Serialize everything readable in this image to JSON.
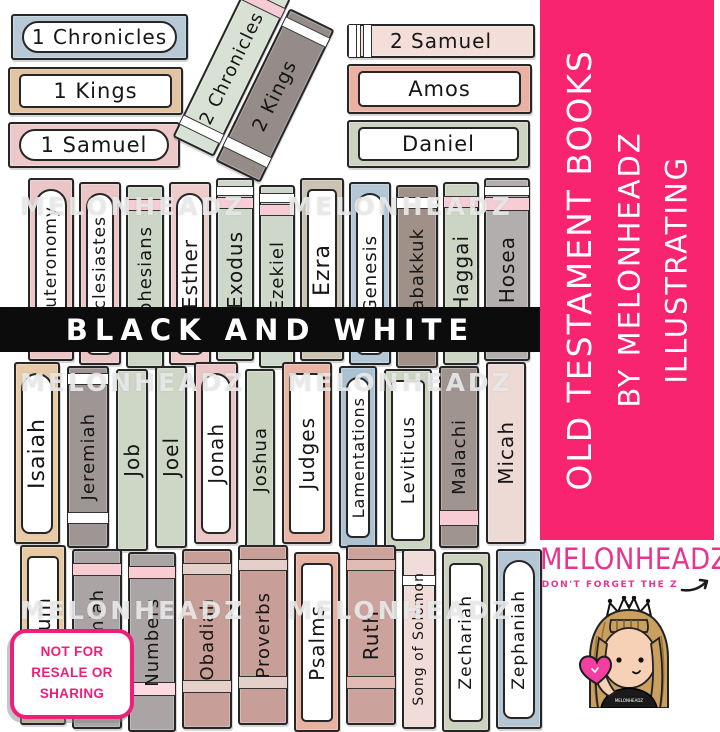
{
  "banner": {
    "text": "BLACK AND WHITE",
    "bg": "#0c0c0c",
    "text_color": "#ffffff"
  },
  "watermark": {
    "text": "MELONHEADZ"
  },
  "sidebar": {
    "bg": "#f9246f",
    "lines": [
      "OLD TESTAMENT BOOKS",
      "BY MELONHEADZ",
      "ILLUSTRATING"
    ]
  },
  "logo": {
    "name": "MELONHEADZ",
    "tagline": "DON'T FORGET THE Z",
    "color": "#e9338f"
  },
  "character": {
    "shirt_text": "MELONHEADZ"
  },
  "badge": {
    "color": "#ee1f78",
    "lines": [
      "NOT FOR",
      "RESALE OR",
      "SHARING"
    ]
  },
  "top_left_books": [
    {
      "label": "1 Chronicles",
      "color": "#b7c9d6",
      "label_type": "pill",
      "w": 177,
      "h": 46,
      "font": 20
    },
    {
      "label": "1 Kings",
      "color": "#e2c4a2",
      "label_type": "rect",
      "w": 175,
      "h": 48,
      "font": 21
    },
    {
      "label": "1 Samuel",
      "color": "#ecc8c8",
      "label_type": "pill",
      "w": 172,
      "h": 46,
      "font": 21
    }
  ],
  "diagonal_books": [
    {
      "label": "2 Chronicles",
      "color": "#d8e2d4",
      "w": 46,
      "h": 176,
      "font": 18,
      "bands": [
        {
          "color": "#f6ccd4",
          "top": 9,
          "h": 10
        },
        {
          "color": "#ffffff",
          "bottom": 12,
          "h": 9
        }
      ]
    },
    {
      "label": "2 Kings",
      "color": "#958c89",
      "w": 50,
      "h": 170,
      "font": 19,
      "bands": [
        {
          "color": "#ffffff",
          "top": 7,
          "h": 9
        },
        {
          "color": "#ffffff",
          "bottom": 14,
          "h": 10
        }
      ]
    }
  ],
  "top_right_books": [
    {
      "label": "2 Samuel",
      "color": "#f3ded9",
      "w": 188,
      "h": 34,
      "font": 20,
      "bands": [
        {
          "color": "#ffffff",
          "left": 4,
          "w": 6
        },
        {
          "color": "#ffffff",
          "left": 14,
          "w": 7
        },
        {
          "color": "#ffffff",
          "right": 4,
          "w": 6
        },
        {
          "color": "#ffffff",
          "right": 14,
          "w": 7
        }
      ]
    },
    {
      "label": "Amos",
      "color": "#e9b2a2",
      "label_type": "rect",
      "w": 185,
      "h": 50,
      "font": 21
    },
    {
      "label": "Daniel",
      "color": "#cdd3c1",
      "label_type": "rect",
      "w": 183,
      "h": 48,
      "font": 21
    }
  ],
  "shelves": [
    {
      "books": [
        {
          "label": "Deuteronomy",
          "color": "#eac6c6",
          "label_type": "arch",
          "w": 46,
          "font": 17
        },
        {
          "label": "Ecclesiastes",
          "color": "#eac6c6",
          "label_type": "arch",
          "w": 42,
          "font": 17
        },
        {
          "label": "Ephesians",
          "color": "#ccd6c6",
          "w": 38,
          "font": 18,
          "bands": [
            {
              "color": "#f7ccd4",
              "top": 12,
              "h": 10
            }
          ]
        },
        {
          "label": "Esther",
          "color": "#eecccc",
          "label_type": "arch",
          "w": 42,
          "font": 20
        },
        {
          "label": "Exodus",
          "color": "#cdd8ca",
          "w": 38,
          "font": 20,
          "bands": [
            {
              "color": "#ffffff",
              "top": 6,
              "h": 8
            },
            {
              "color": "#f7ccd4",
              "top": 17,
              "h": 10
            }
          ]
        },
        {
          "label": "Ezekiel",
          "color": "#cdd8ca",
          "w": 36,
          "font": 18,
          "bands": [
            {
              "color": "#ffffff",
              "top": 6,
              "h": 8
            },
            {
              "color": "#f7ccd4",
              "top": 17,
              "h": 10
            }
          ]
        },
        {
          "label": "Ezra",
          "color": "#cbc4b2",
          "label_type": "rect",
          "w": 44,
          "font": 22
        },
        {
          "label": "Genesis",
          "color": "#b3c7d6",
          "label_type": "arch",
          "w": 42,
          "font": 18
        },
        {
          "label": "Habakkuk",
          "color": "#a09188",
          "w": 42,
          "font": 18,
          "bands": [
            {
              "color": "#ffffff",
              "top": 10,
              "h": 10
            }
          ]
        },
        {
          "label": "Haggai",
          "color": "#ccd4c4",
          "w": 36,
          "font": 20,
          "bands": [
            {
              "color": "#f7ccd4",
              "top": 12,
              "h": 10
            }
          ]
        },
        {
          "label": "Hosea",
          "color": "#b3aeae",
          "w": 46,
          "font": 20,
          "bands": [
            {
              "color": "#ffffff",
              "top": 6,
              "h": 8
            },
            {
              "color": "#f7ccd4",
              "top": 17,
              "h": 12
            }
          ]
        }
      ]
    },
    {
      "books": [
        {
          "label": "Isaiah",
          "color": "#e8cba6",
          "label_type": "arch",
          "w": 46,
          "font": 22
        },
        {
          "label": "Jeremiah",
          "color": "#9e9595",
          "w": 42,
          "font": 18,
          "bands": [
            {
              "color": "#ffffff",
              "top": 5,
              "h": 10
            },
            {
              "color": "#ffffff",
              "bottom": 22,
              "h": 10
            }
          ]
        },
        {
          "label": "Job",
          "color": "#ced6c6",
          "w": 32,
          "font": 20
        },
        {
          "label": "Joel",
          "color": "#ced6c6",
          "w": 32,
          "font": 20
        },
        {
          "label": "Jonah",
          "color": "#ecc6c6",
          "label_type": "arch",
          "w": 44,
          "font": 20
        },
        {
          "label": "Joshua",
          "color": "#c9d1bf",
          "w": 30,
          "font": 18
        },
        {
          "label": "Judges",
          "color": "#e9b4a4",
          "label_type": "rect",
          "w": 50,
          "font": 20
        },
        {
          "label": "Lamentations",
          "color": "#aac2d4",
          "label_type": "arch",
          "w": 38,
          "font": 16
        },
        {
          "label": "Leviticus",
          "color": "#ccd4c2",
          "label_type": "rect",
          "w": 48,
          "font": 18
        },
        {
          "label": "Malachi",
          "color": "#9f9490",
          "w": 40,
          "font": 18,
          "bands": [
            {
              "color": "#f7ccd4",
              "bottom": 20,
              "h": 14
            }
          ]
        },
        {
          "label": "Micah",
          "color": "#eedad4",
          "w": 40,
          "font": 20
        }
      ]
    },
    {
      "books": [
        {
          "label": "Nahum",
          "color": "#e6c9a2",
          "label_type": "rect",
          "w": 46,
          "font": 20
        },
        {
          "label": "Nehemiah",
          "color": "#aaa4a4",
          "w": 50,
          "font": 18,
          "bands": [
            {
              "color": "#f9ccd4",
              "top": 12,
              "h": 11
            },
            {
              "color": "#fbd9de",
              "bottom": 34,
              "h": 12
            }
          ]
        },
        {
          "label": "Numbers",
          "color": "#aaa4a4",
          "w": 48,
          "font": 18,
          "bands": [
            {
              "color": "#f9ccd4",
              "top": 12,
              "h": 11
            },
            {
              "color": "#fbd9de",
              "bottom": 34,
              "h": 12
            }
          ]
        },
        {
          "label": "Obadiah",
          "color": "#c79e98",
          "w": 50,
          "font": 18,
          "bands": [
            {
              "color": "#e4d0c9",
              "top": 12,
              "h": 10
            },
            {
              "color": "#e4d0c9",
              "bottom": 34,
              "h": 11
            }
          ]
        },
        {
          "label": "Proverbs",
          "color": "#c79e98",
          "w": 50,
          "font": 18,
          "bands": [
            {
              "color": "#e4d0c9",
              "top": 12,
              "h": 10
            },
            {
              "color": "#e4d0c9",
              "bottom": 34,
              "h": 11
            }
          ]
        },
        {
          "label": "Psalms",
          "color": "#e7b2a2",
          "label_type": "rect",
          "w": 46,
          "font": 20
        },
        {
          "label": "Ruth",
          "color": "#cca29c",
          "w": 50,
          "font": 20,
          "bands": [
            {
              "color": "#e0bcb4",
              "top": 12,
              "h": 10
            },
            {
              "color": "#e0bcb4",
              "bottom": 34,
              "h": 11
            }
          ]
        },
        {
          "label": "Song of Solomon",
          "color": "#f0dcd8",
          "w": 34,
          "font": 14,
          "bands": [
            {
              "color": "#ffffff",
              "top": 24,
              "h": 9
            }
          ]
        },
        {
          "label": "Zechariah",
          "color": "#ccd2c0",
          "label_type": "rect",
          "w": 48,
          "font": 17
        },
        {
          "label": "Zephaniah",
          "color": "#b4c6d4",
          "label_type": "arch",
          "w": 46,
          "font": 17
        }
      ]
    }
  ]
}
